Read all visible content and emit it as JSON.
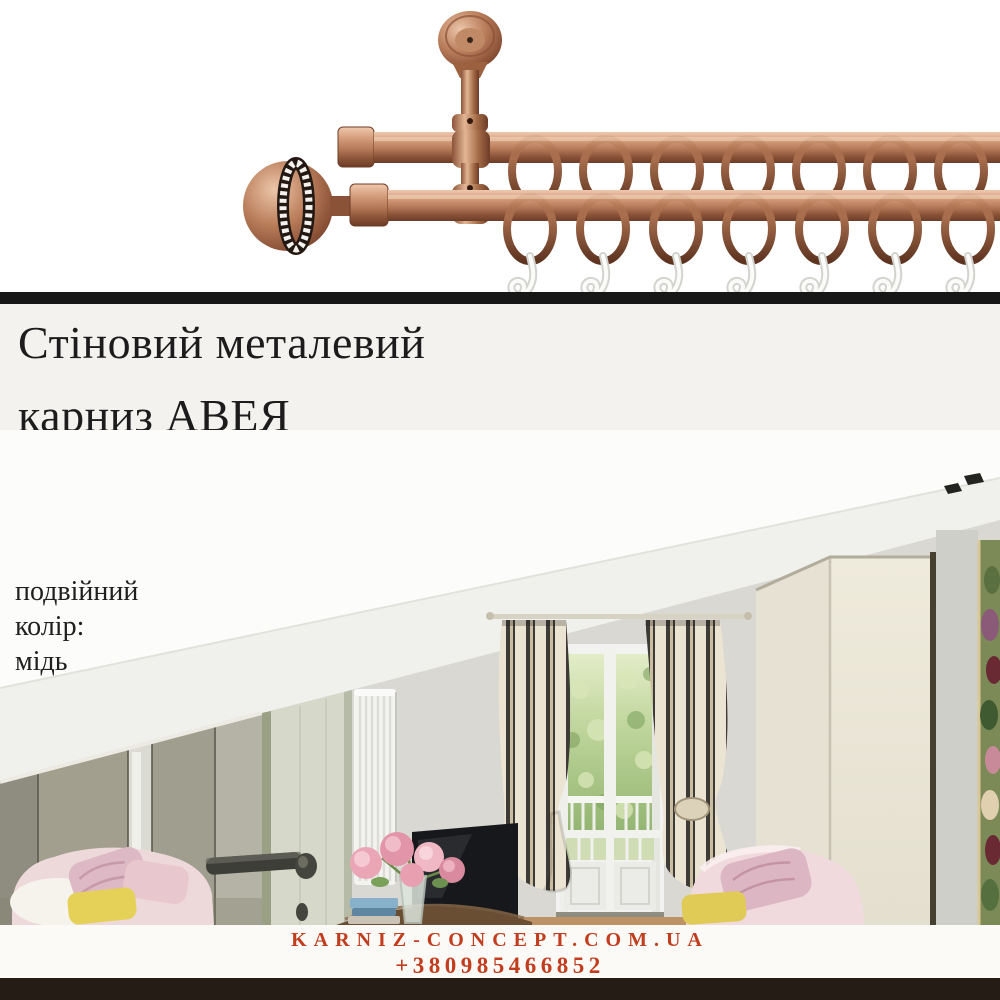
{
  "divider": {
    "color": "#171717"
  },
  "product": {
    "name": "double-curtain-rod-photo",
    "copper_color": "#b97d5e",
    "ring_count_per_rod": 7,
    "hook_count": 7
  },
  "headline": {
    "lines": [
      "Стіновий металевий",
      "карниз АВЕЯ",
      "класична колекція 16 мм"
    ]
  },
  "specs": {
    "lines": [
      "подвійний",
      "колір:",
      "мідь"
    ]
  },
  "room_photo": {
    "name": "interior-room-photo"
  },
  "footer": {
    "site": "KARNIZ-CONCEPT.COM.UA",
    "phone": "+380985466852",
    "accent_color": "#c13d1e",
    "bar_color": "#241c15"
  }
}
